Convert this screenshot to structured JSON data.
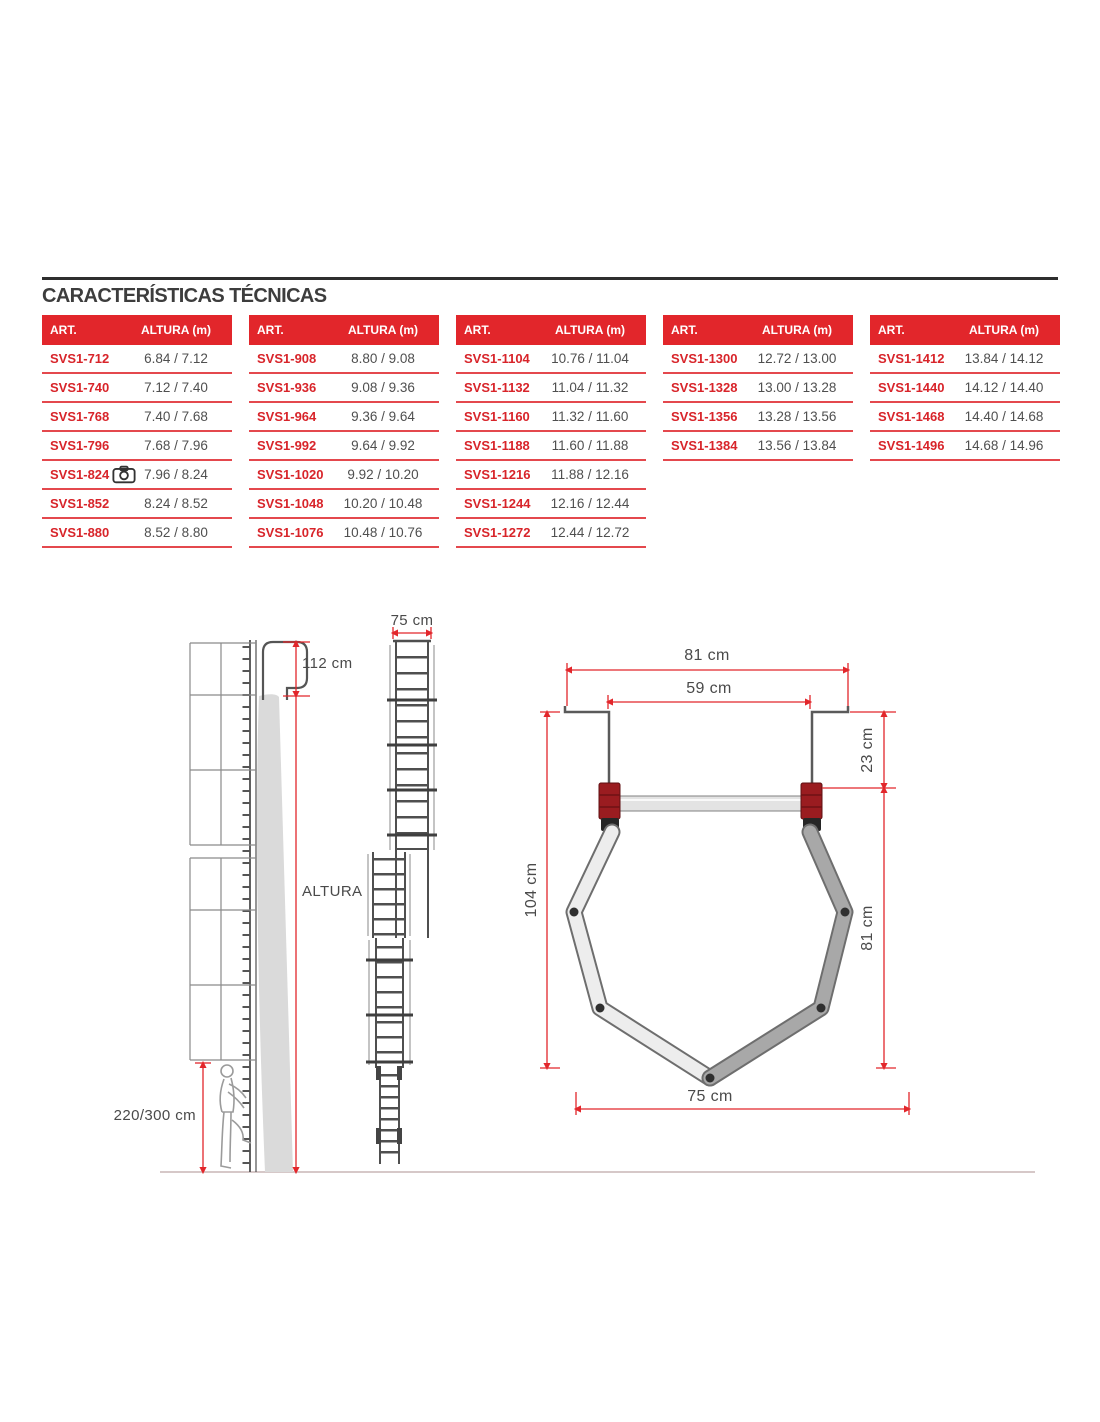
{
  "title": "CARACTERÍSTICAS TÉCNICAS",
  "table_columns": {
    "art": "ART.",
    "altura": "ALTURA (m)"
  },
  "tables": [
    {
      "rows": [
        {
          "art": "SVS1-712",
          "altura": "6.84 / 7.12"
        },
        {
          "art": "SVS1-740",
          "altura": "7.12 / 7.40"
        },
        {
          "art": "SVS1-768",
          "altura": "7.40 / 7.68"
        },
        {
          "art": "SVS1-796",
          "altura": "7.68 / 7.96"
        },
        {
          "art": "SVS1-824",
          "altura": "7.96 / 8.24",
          "icon": "camera-icon"
        },
        {
          "art": "SVS1-852",
          "altura": "8.24 / 8.52"
        },
        {
          "art": "SVS1-880",
          "altura": "8.52 / 8.80"
        }
      ]
    },
    {
      "rows": [
        {
          "art": "SVS1-908",
          "altura": "8.80 / 9.08"
        },
        {
          "art": "SVS1-936",
          "altura": "9.08 / 9.36"
        },
        {
          "art": "SVS1-964",
          "altura": "9.36 / 9.64"
        },
        {
          "art": "SVS1-992",
          "altura": "9.64 / 9.92"
        },
        {
          "art": "SVS1-1020",
          "altura": "9.92 / 10.20"
        },
        {
          "art": "SVS1-1048",
          "altura": "10.20 / 10.48"
        },
        {
          "art": "SVS1-1076",
          "altura": "10.48 / 10.76"
        }
      ]
    },
    {
      "rows": [
        {
          "art": "SVS1-1104",
          "altura": "10.76 / 11.04"
        },
        {
          "art": "SVS1-1132",
          "altura": "11.04 / 11.32"
        },
        {
          "art": "SVS1-1160",
          "altura": "11.32 / 11.60"
        },
        {
          "art": "SVS1-1188",
          "altura": "11.60 / 11.88"
        },
        {
          "art": "SVS1-1216",
          "altura": "11.88 / 12.16"
        },
        {
          "art": "SVS1-1244",
          "altura": "12.16 / 12.44"
        },
        {
          "art": "SVS1-1272",
          "altura": "12.44 / 12.72"
        }
      ]
    },
    {
      "rows": [
        {
          "art": "SVS1-1300",
          "altura": "12.72 / 13.00"
        },
        {
          "art": "SVS1-1328",
          "altura": "13.00 / 13.28"
        },
        {
          "art": "SVS1-1356",
          "altura": "13.28 / 13.56"
        },
        {
          "art": "SVS1-1384",
          "altura": "13.56 / 13.84"
        }
      ]
    },
    {
      "rows": [
        {
          "art": "SVS1-1412",
          "altura": "13.84 / 14.12"
        },
        {
          "art": "SVS1-1440",
          "altura": "14.12 / 14.40"
        },
        {
          "art": "SVS1-1468",
          "altura": "14.40 / 14.68"
        },
        {
          "art": "SVS1-1496",
          "altura": "14.68 / 14.96"
        }
      ]
    }
  ],
  "diagrams": {
    "side_view": {
      "top_dim": "112 cm",
      "height_label": "ALTURA",
      "ground_dim": "220/300 cm"
    },
    "front_view": {
      "width_dim": "75 cm"
    },
    "cross_section": {
      "outer_width": "81 cm",
      "inner_width": "59 cm",
      "wall_offset": "23 cm",
      "total_height": "104 cm",
      "cage_height": "81 cm",
      "bottom_width": "75 cm"
    }
  },
  "colors": {
    "brand_red": "#e2262b",
    "row_separator_red": "#e4484d",
    "dimension_red": "#e2262b",
    "title_gray": "#3d3d3d",
    "value_gray": "#4f4f4f"
  }
}
